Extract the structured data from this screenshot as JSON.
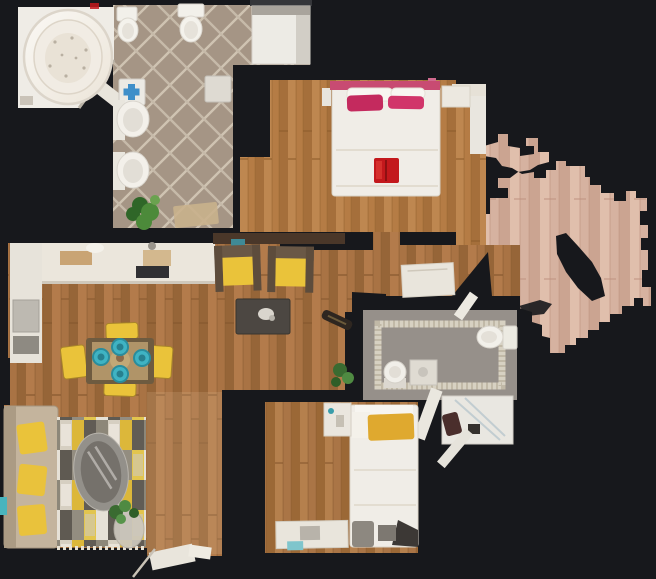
{
  "scene": {
    "kind": "3d-scan-floorplan-top-view",
    "width": 656,
    "height": 579
  },
  "palette": {
    "background": "#17181c",
    "wood_living": "#a97344",
    "wood_living_light": "#b57d4c",
    "wood_living_dark": "#8f5f33",
    "wood_master": "#b57c45",
    "wood_master_light": "#c08a52",
    "wood_bedroom2": "#aa7546",
    "wood_corridor_overlay": "#d8b388",
    "wood_outside": "#d6b2a0",
    "wood_outside_light": "#e3c2b0",
    "tile_base": "#a59585",
    "tile_grout": "#cfc3b2",
    "bath2_floor": "#96908a",
    "mosaic_border": "#d7d1c2",
    "fixture_white": "#f2f0ea",
    "fixture_stroke": "#d8d4cc",
    "counter_white": "#ebe6dc",
    "bed_white": "#f0ede7",
    "headboard_pink": "#c84b72",
    "pillow_pink": "#c42a5e",
    "pillow_pink2": "#d1356a",
    "red_tray": "#c3181c",
    "accent_yellow": "#eac33a",
    "mustard_pillow": "#dfa92f",
    "accent_teal": "#3fb3c3",
    "sofa_frame": "#c4b49d",
    "armchair_frame": "#5d4c3c",
    "armchair_back": "#6a5846",
    "coffee_table": "#4c4742",
    "dining_table": "#6e5b40",
    "dining_table_panel": "#b09468",
    "rug_cream": "#d6cfc1",
    "rug_gray": "#8d8779",
    "rug_yellow": "#dcb73a",
    "rug_dark": "#615c55",
    "plant_green": "#4c8a3a",
    "plant_green_dark": "#2f6628",
    "plant_green_light": "#6aa24f",
    "wall_brown": "#4a3729",
    "cooktop_dark": "#303033",
    "cross_blue": "#3f8fc9",
    "oval_table_rim": "#93908a",
    "oval_table_glass": "#75716b",
    "door_white": "#e9e5dc",
    "shower_gray": "#a9a49c",
    "laundry_dark_red": "#4a2e2c",
    "tan_mat": "#c9b18c",
    "tan_board": "#c9a474"
  },
  "rooms": [
    {
      "id": "bathroom-main",
      "items": [
        "jacuzzi-tub",
        "bidet",
        "toilet",
        "shower-tray",
        "medicine-cabinet-blue-cross",
        "cabinet",
        "sink",
        "sink",
        "plant",
        "bath-mat"
      ]
    },
    {
      "id": "master-bedroom",
      "items": [
        "double-bed",
        "white-pillows",
        "pink-pillows",
        "red-breakfast-tray",
        "nightstand",
        "nightstand"
      ]
    },
    {
      "id": "living-dining-room",
      "items": [
        "kitchen-counter-top",
        "kitchen-counter-left",
        "cooktop",
        "cutting-board",
        "armchair",
        "armchair",
        "coffee-table",
        "dining-table",
        "teal-plates",
        "dining-chair",
        "dining-chair",
        "dining-chair",
        "dining-chair",
        "sofa",
        "geometric-rug",
        "oval-glass-table",
        "plant"
      ]
    },
    {
      "id": "corridor",
      "items": [
        "open-door-bottom"
      ]
    },
    {
      "id": "entry-hall",
      "items": [
        "open-front-door",
        "dark-floor-object"
      ]
    },
    {
      "id": "bathroom-2",
      "items": [
        "mosaic-border",
        "toilet",
        "pedestal-sink",
        "washing-machine",
        "shower-cabin",
        "laundry-item",
        "open-glass-door",
        "plant"
      ]
    },
    {
      "id": "bedroom-2",
      "items": [
        "single-bed",
        "yellow-pillow",
        "nightstand",
        "desk",
        "stool"
      ]
    },
    {
      "id": "outside-landing",
      "items": [
        "partial-scan-floor"
      ]
    }
  ]
}
